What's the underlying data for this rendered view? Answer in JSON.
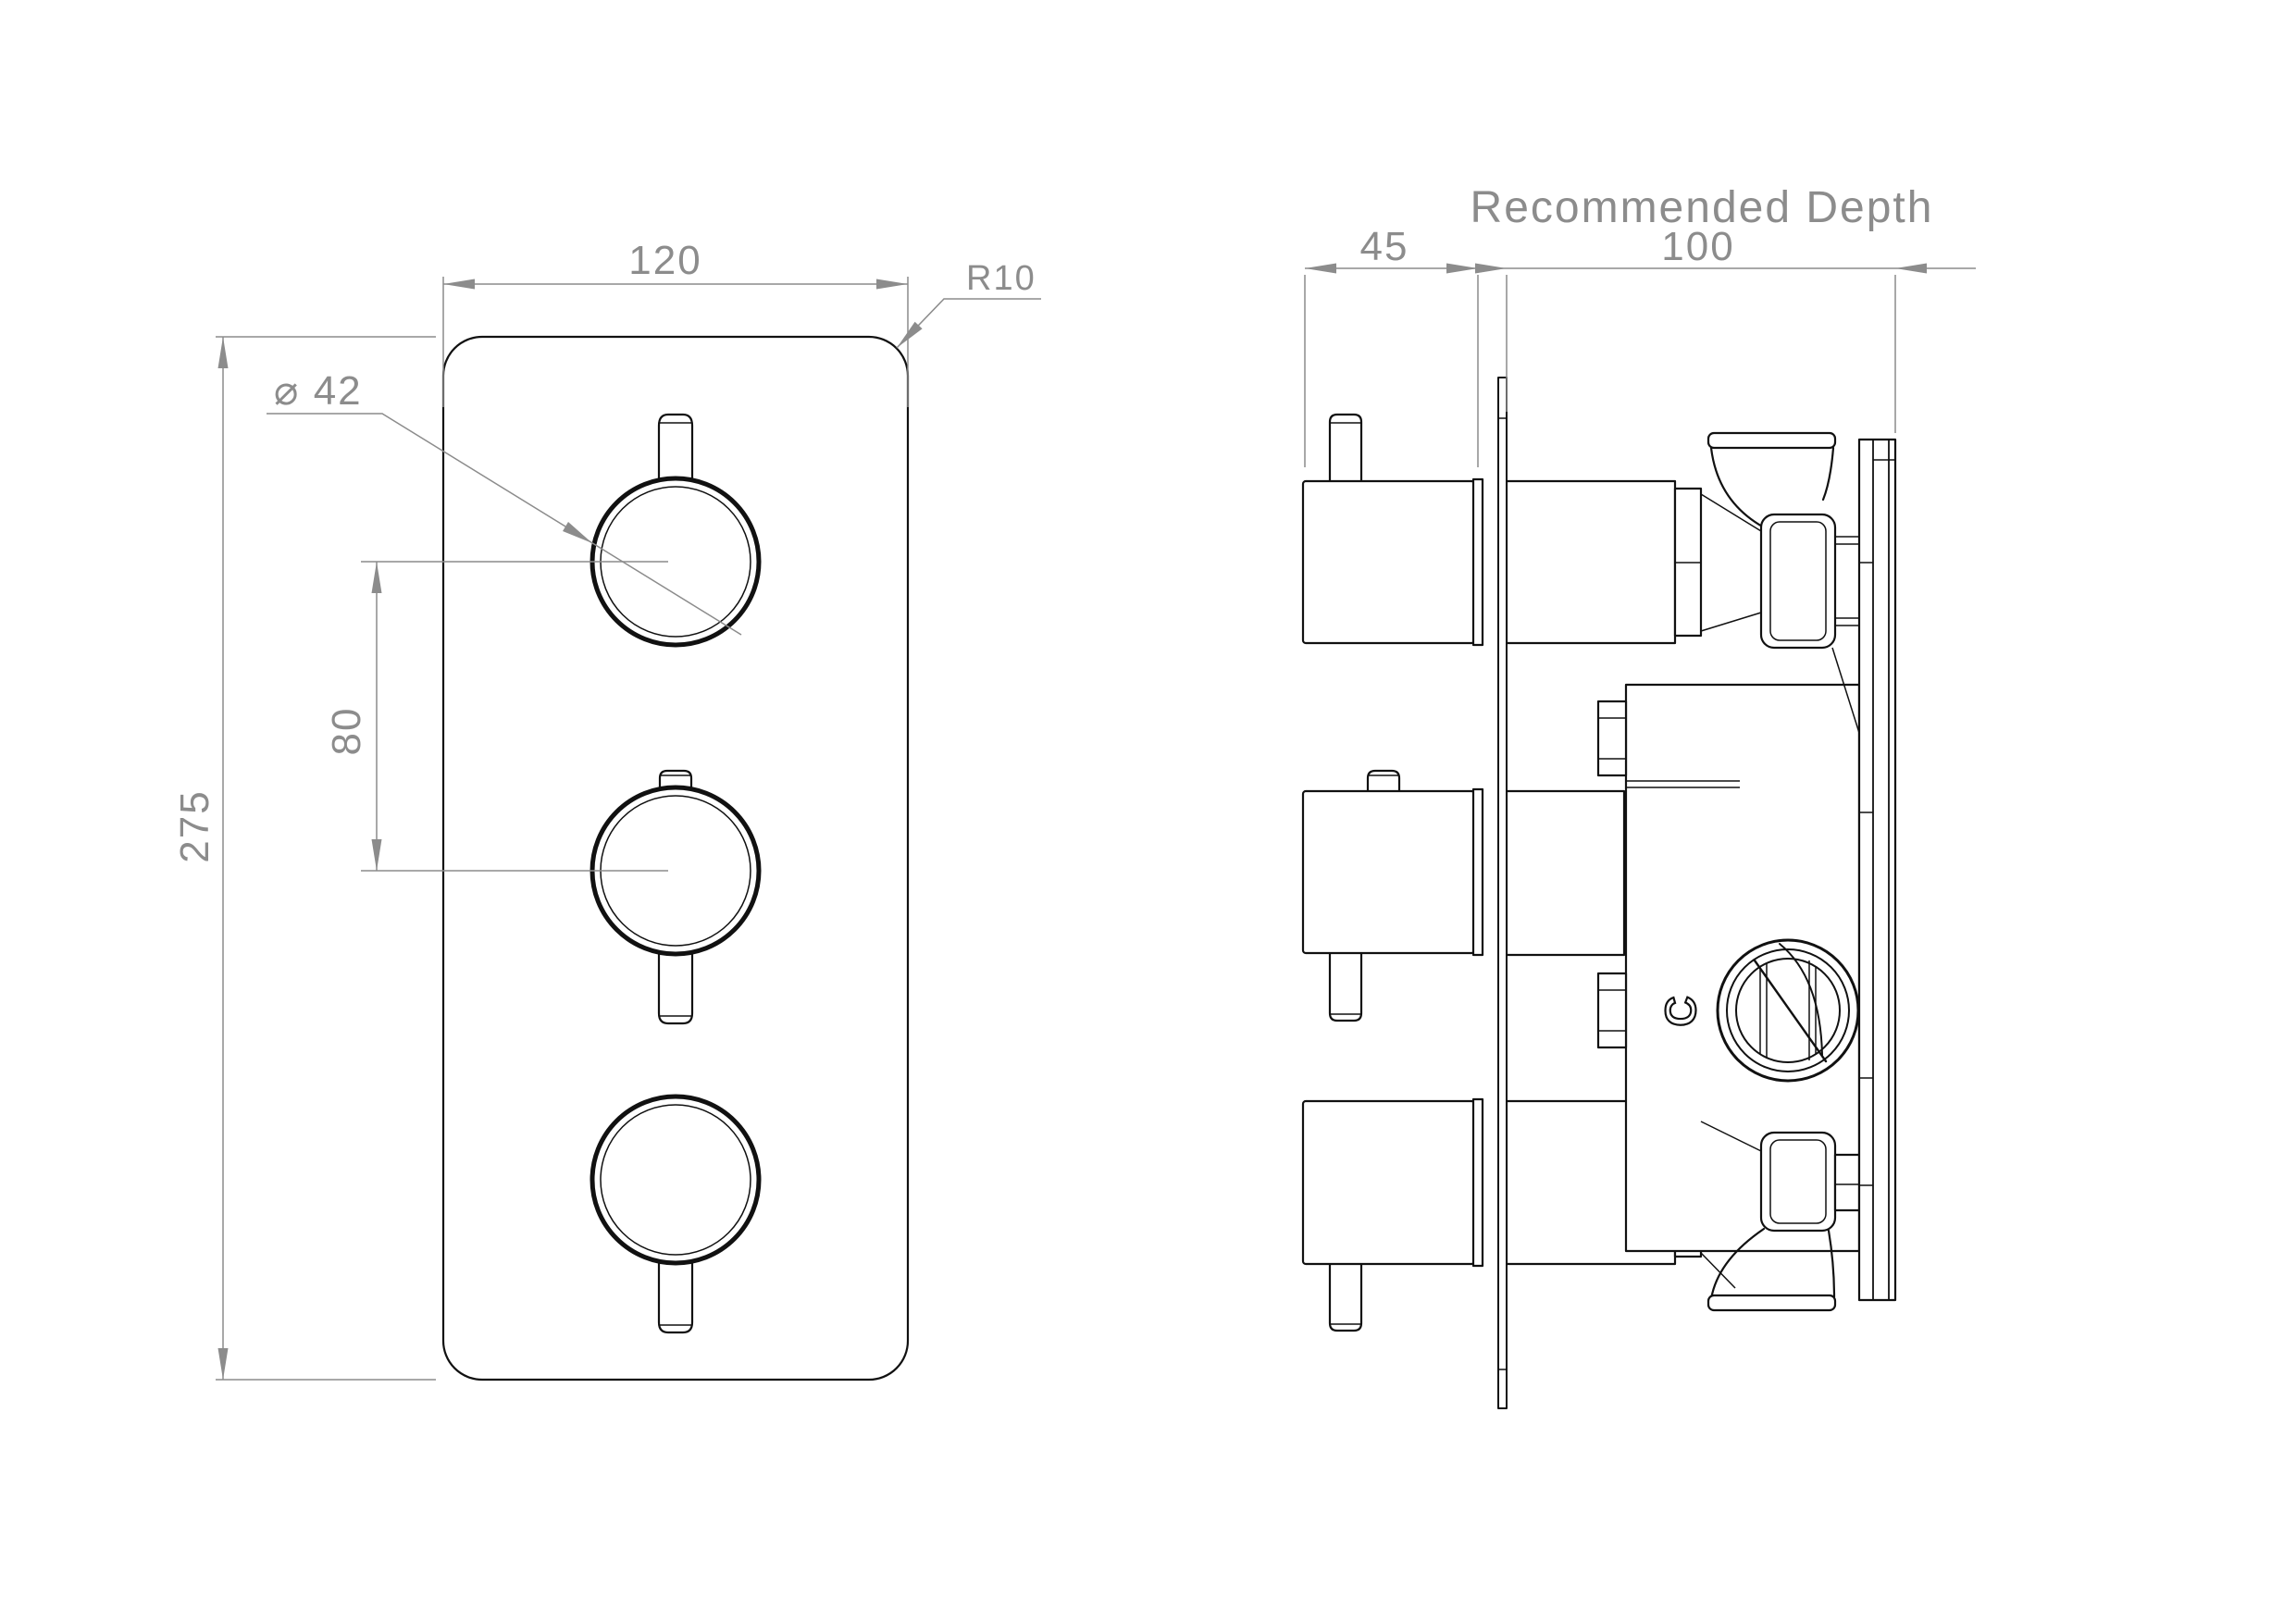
{
  "drawing": {
    "front_view": {
      "width_mm": "120",
      "height_mm": "275",
      "handle_spacing_mm": "80",
      "handle_diameter": "⌀ 42",
      "corner_radius": "R10"
    },
    "side_view": {
      "depth_heading": "Recommended Depth",
      "recommended_depth_mm": "100",
      "protrusion_mm": "45",
      "valve_marking": "C"
    },
    "colors": {
      "line": "#111111",
      "dimension": "#8c8c8c",
      "background": "#ffffff"
    }
  }
}
